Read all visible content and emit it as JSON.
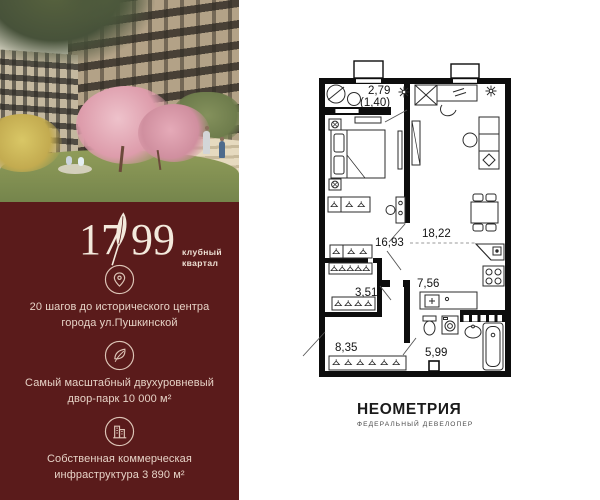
{
  "left_panel": {
    "brand_color": "#5a1b1b",
    "logo": {
      "number_left": "17",
      "number_right": "99",
      "feather_icon": "feather-icon",
      "tagline_line1": "клубный",
      "tagline_line2": "квартал"
    },
    "features": [
      {
        "icon": "location-pin-icon",
        "line1": "20 шагов до исторического центра",
        "line2": "города ул.Пушкинской"
      },
      {
        "icon": "leaf-icon",
        "line1": "Самый масштабный двухуровневый",
        "line2": "двор-парк 10 000 м²"
      },
      {
        "icon": "buildings-icon",
        "line1": "Собственная коммерческая",
        "line2": "инфраструктура 3 890 м²"
      }
    ]
  },
  "floor_plan": {
    "wall_color": "#0d0d0d",
    "labels": {
      "balcony_area": "2,79",
      "balcony_area_reduced": "(1,40)",
      "bedroom_area": "16,93",
      "living_kitchen_area": "18,22",
      "wardrobe_area": "3,51",
      "hall_area": "7,56",
      "corridor_area": "8,35",
      "bathroom_area": "5,99"
    }
  },
  "developer": {
    "name": "НЕОМЕТРИЯ",
    "subtitle": "ФЕДЕРАЛЬНЫЙ ДЕВЕЛОПЕР"
  }
}
